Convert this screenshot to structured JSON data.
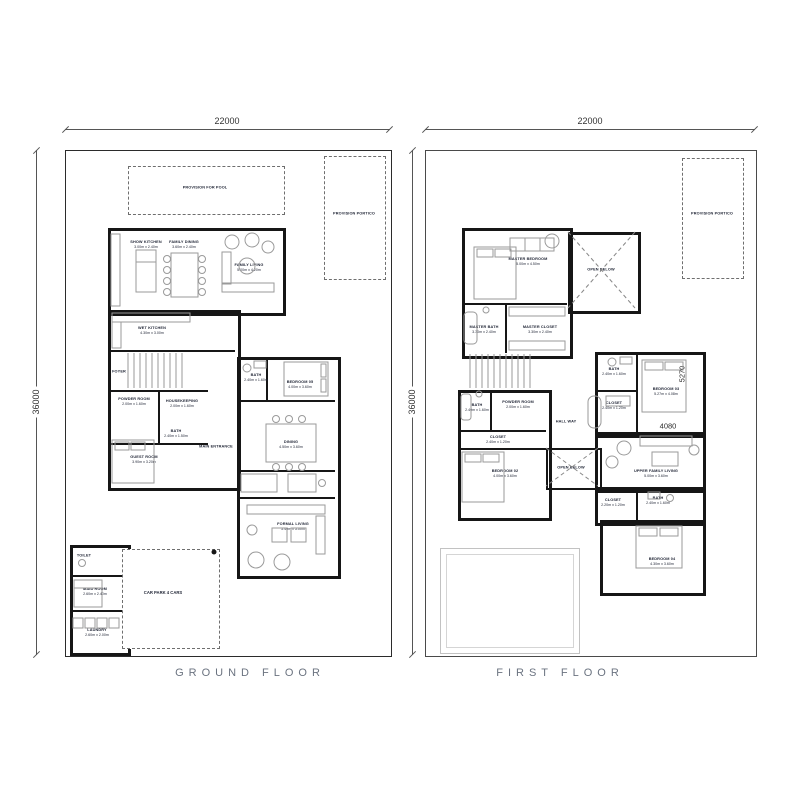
{
  "titles": {
    "ground": "GROUND FLOOR",
    "first": "FIRST FLOOR"
  },
  "dimensions": {
    "plot_width": "22000",
    "plot_depth": "36000",
    "bedroom03_depth": "5270",
    "bedroom03_width": "4080"
  },
  "colors": {
    "wall": "#161616",
    "label": "#232838",
    "title": "#6b7380",
    "dashed": "#6e6e6e",
    "furniture": "#9a9a9a"
  },
  "ground": {
    "provision_pool": "PROVISION FOR POOL",
    "provision_portico": "PROVISION PORTICO",
    "car_park": "CAR PARK 4 CARS",
    "rooms": [
      {
        "name": "SHOW KITCHEN",
        "dims": "3.00m x 2.40m"
      },
      {
        "name": "FAMILY DINING",
        "dims": "3.60m x 2.40m"
      },
      {
        "name": "FAMILY LIVING",
        "dims": "5.00m x 4.20m"
      },
      {
        "name": "WET KITCHEN",
        "dims": "4.30m x 3.00m"
      },
      {
        "name": "FOYER"
      },
      {
        "name": "POWDER ROOM",
        "dims": "2.00m x 1.60m"
      },
      {
        "name": "HOUSEKEEPING",
        "dims": "2.00m x 1.60m"
      },
      {
        "name": "BATH",
        "dims": "2.40m x 1.50m"
      },
      {
        "name": "GUEST ROOM",
        "dims": "3.90m x 3.20m"
      },
      {
        "name": "MAIN ENTRANCE"
      },
      {
        "name": "BATH",
        "dims": "2.40m x 1.60m"
      },
      {
        "name": "BEDROOM 05",
        "dims": "4.00m x 3.60m"
      },
      {
        "name": "DINING",
        "dims": "4.50m x 3.60m"
      },
      {
        "name": "FORMAL LIVING",
        "dims": "5.40m x 5.00m"
      },
      {
        "name": "TOILET"
      },
      {
        "name": "MAID ROOM",
        "dims": "2.60m x 2.40m"
      },
      {
        "name": "LAUNDRY",
        "dims": "2.60m x 2.00m"
      }
    ]
  },
  "first": {
    "provision_portico": "PROVISION PORTICO",
    "rooms": [
      {
        "name": "MASTER BEDROOM",
        "dims": "5.00m x 4.50m"
      },
      {
        "name": "OPEN BELOW"
      },
      {
        "name": "MASTER BATH",
        "dims": "3.30m x 2.40m"
      },
      {
        "name": "MASTER CLOSET",
        "dims": "3.30m x 2.40m"
      },
      {
        "name": "BATH",
        "dims": "2.40m x 1.60m"
      },
      {
        "name": "POWDER ROOM",
        "dims": "2.00m x 1.60m"
      },
      {
        "name": "CLOSET",
        "dims": "2.40m x 1.20m"
      },
      {
        "name": "BEDROOM 02",
        "dims": "4.00m x 3.60m"
      },
      {
        "name": "HALL WAY"
      },
      {
        "name": "OPEN BELOW"
      },
      {
        "name": "BATH",
        "dims": "2.40m x 1.60m"
      },
      {
        "name": "CLOSET",
        "dims": "2.40m x 1.20m"
      },
      {
        "name": "BEDROOM 03",
        "dims": "5.27m x 4.08m"
      },
      {
        "name": "UPPER FAMILY LIVING",
        "dims": "5.00m x 3.60m"
      },
      {
        "name": "CLOSET",
        "dims": "2.20m x 1.20m"
      },
      {
        "name": "BATH",
        "dims": "2.40m x 1.60m"
      },
      {
        "name": "BEDROOM 04",
        "dims": "4.30m x 3.60m"
      }
    ]
  }
}
